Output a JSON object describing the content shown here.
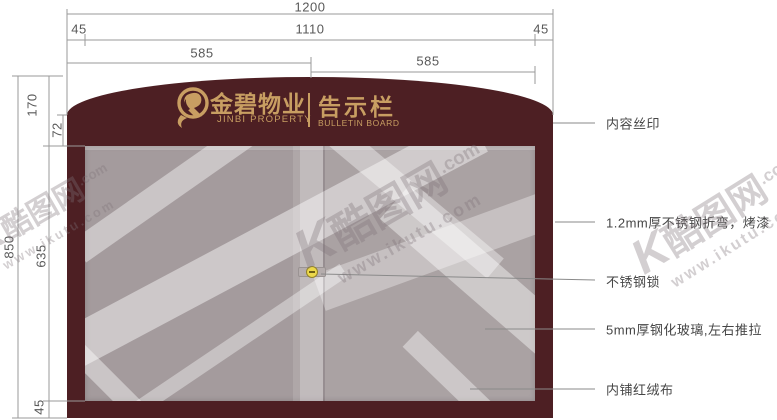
{
  "dims": {
    "total_width": "1200",
    "side_left": "45",
    "inner_width": "1110",
    "side_right": "45",
    "half_left": "585",
    "half_right": "585",
    "total_height": "850",
    "header_height": "170",
    "corner_height": "72",
    "glass_height": "635",
    "bottom_height": "45"
  },
  "board": {
    "logo_cn": "金碧物业",
    "logo_en": "JINBI PROPERTY",
    "title_cn": "告示栏",
    "title_en": "BULLETIN BOARD"
  },
  "callouts": [
    "内容丝印",
    "1.2mm厚不锈钢折弯，烤漆",
    "不锈钢锁",
    "5mm厚钢化玻璃,左右推拉",
    "内铺红绒布"
  ],
  "watermark": {
    "k": "K",
    "brand": "酷图网",
    "dotcom": ".com",
    "url": "www.ikutu.com"
  },
  "colors": {
    "frame": "#4d1f23",
    "gold": "#c89e62",
    "glass": "#a49b9d",
    "lock": "#ecd84b"
  }
}
